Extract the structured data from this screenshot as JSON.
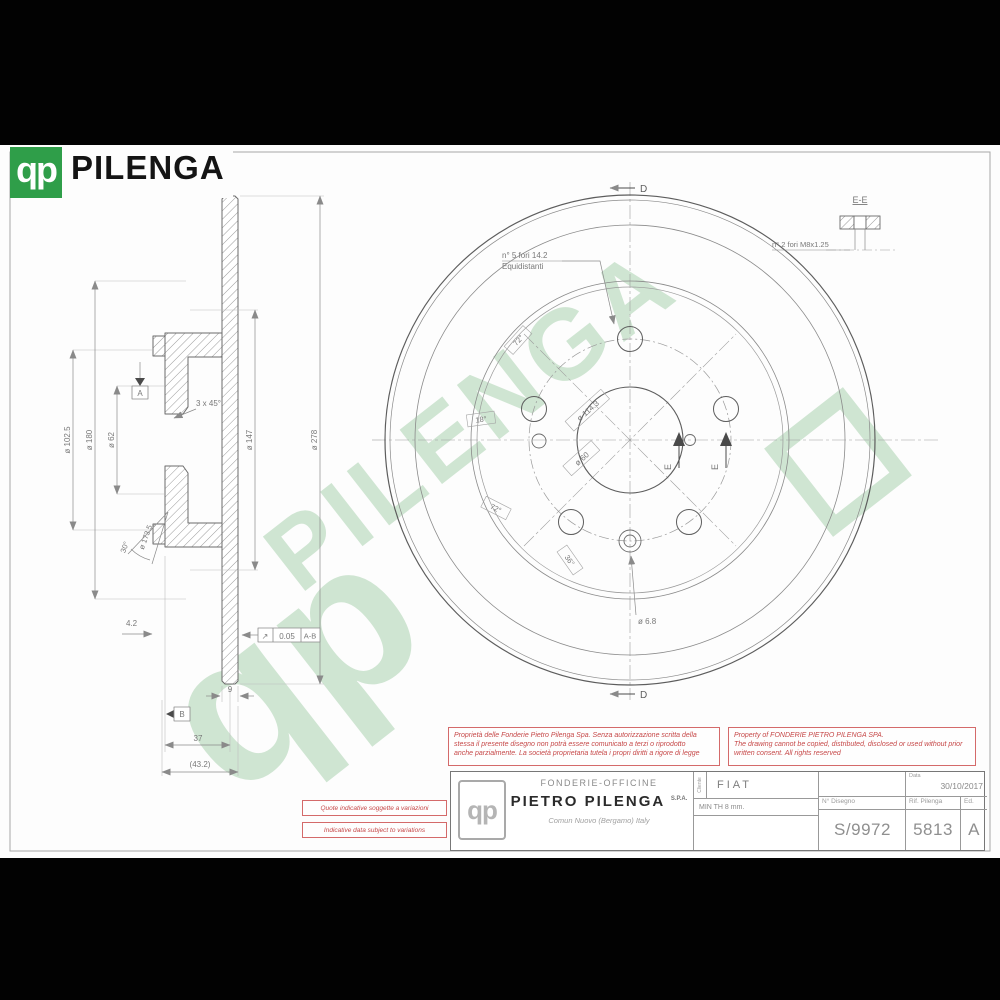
{
  "brand": {
    "logo_glyph": "qp",
    "name": "PILENGA"
  },
  "watermark": {
    "logo_glyph": "qp",
    "text": "PILENGA"
  },
  "drawing": {
    "section_view": {
      "dia_hub": "ø 102.5",
      "dia_drum_out": "ø 180",
      "dia_bore": "ø 62",
      "dia_drum_in": "ø 147",
      "dia_outer": "ø 278",
      "chamfer": "3 x 45°",
      "drum_angle": "30°",
      "drum_surface": "ø 173.5",
      "depth": "4.2",
      "thickness": "9",
      "height": "37",
      "overall_width": "(43.2)",
      "runout_symbol": "↗",
      "runout_value": "0.05",
      "runout_datums": "A-B",
      "datum_a": "A",
      "datum_b": "B"
    },
    "front_view": {
      "holes_note_line1": "n° 5 fori 14.2",
      "holes_note_line2": "Equidistanti",
      "bolt_circle": "ø 114.3",
      "center_bore": "ø 60",
      "pin_hole": "ø 6.8",
      "angle_labels": [
        "72°",
        "18°",
        "72°",
        "36°"
      ],
      "section_d": "D",
      "section_e": "E"
    },
    "detail_ee": {
      "title": "E-E",
      "note": "n° 2 fori M8x1.25"
    }
  },
  "warnings": {
    "italian": [
      "Proprietà delle Fonderie Pietro Pilenga Spa. Senza autorizzazione scritta della",
      "stessa il presente disegno non potrà essere comunicato a terzi o riprodotto",
      "anche parzialmente. La società proprietaria tutela i propri diritti a rigore di legge"
    ],
    "english": [
      "Property of FONDERIE PIETRO PILENGA SPA.",
      "The drawing cannot be copied, distributed, disclosed or used without prior",
      "written consent. All rights reserved"
    ],
    "note_it": "Quote indicative soggette a variazioni",
    "note_en": "Indicative data subject to variations"
  },
  "title_block": {
    "logo_glyph": "qp",
    "company_line1": "FONDERIE-OFFICINE",
    "company_line2": "PIETRO  PILENGA",
    "company_suffix": "S.P.A.",
    "company_line3": "Comun Nuovo (Bergamo) Italy",
    "client_label": "Cliente",
    "client": "FIAT",
    "min_th": "MIN TH 8 mm.",
    "date_label": "Data",
    "date": "30/10/2017",
    "drawing_no_label": "N° Disegno",
    "drawing_no": "S/9972",
    "ref_label": "Rif. Pilenga",
    "ref": "5813",
    "edition_label": "Ed.",
    "edition": "A"
  }
}
